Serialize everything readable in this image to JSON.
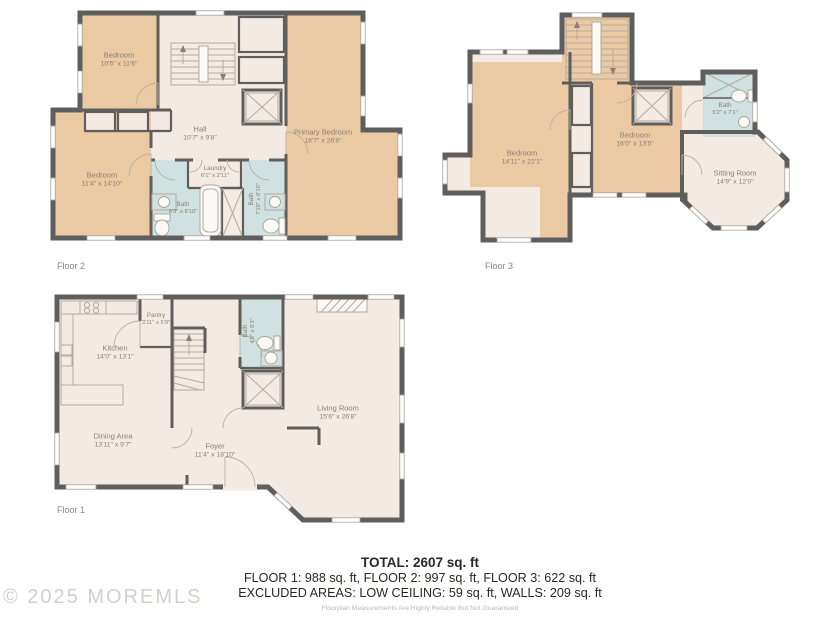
{
  "watermark": "© 2025 MOREMLS",
  "colors": {
    "wall": "#5f5e5c",
    "room_tan": "#ebc9a3",
    "room_cream": "#f3eae3",
    "room_blue": "#cfe2e1",
    "label_text": "#8b8073",
    "footer_text": "#2b2724",
    "watermark_text": "#d3cfcb"
  },
  "floors": {
    "f2": {
      "caption": "Floor 2",
      "rooms": {
        "bedroom1": {
          "name": "Bedroom",
          "dims": "10'5\" x 11'6\""
        },
        "bedroom2": {
          "name": "Bedroom",
          "dims": "11'4\" x 14'10\""
        },
        "hall": {
          "name": "Hall",
          "dims": "10'7\" x 9'8\""
        },
        "laundry": {
          "name": "Laundry",
          "dims": "6'1\" x 2'11\""
        },
        "bath1": {
          "name": "Bath",
          "dims": "8'3\" x 8'10\""
        },
        "bath2": {
          "name": "Bath",
          "dims": "7'10\" x 8'10\""
        },
        "primary": {
          "name": "Primary Bedroom",
          "dims": "18'7\" x 26'8\""
        }
      }
    },
    "f3": {
      "caption": "Floor 3",
      "rooms": {
        "bedroom1": {
          "name": "Bedroom",
          "dims": "14'11\" x 22'1\""
        },
        "bedroom2": {
          "name": "Bedroom",
          "dims": "16'0\" x 13'5\""
        },
        "bath": {
          "name": "Bath",
          "dims": "5'2\" x 7'1\""
        },
        "sitting": {
          "name": "Sitting Room",
          "dims": "14'9\" x 12'0\""
        }
      }
    },
    "f1": {
      "caption": "Floor 1",
      "rooms": {
        "kitchen": {
          "name": "Kitchen",
          "dims": "14'0\" x 13'1\""
        },
        "pantry": {
          "name": "Pantry",
          "dims": "3'11\" x 5'9\""
        },
        "bath": {
          "name": "Bath",
          "dims": "4'9\" x 8'3\""
        },
        "dining": {
          "name": "Dining Area",
          "dims": "13'11\" x 9'7\""
        },
        "foyer": {
          "name": "Foyer",
          "dims": "11'4\" x 18'10\""
        },
        "living": {
          "name": "Living Room",
          "dims": "15'6\" x 26'8\""
        }
      }
    }
  },
  "footer": {
    "total": "TOTAL: 2607 sq. ft",
    "floors_line": "FLOOR 1: 988 sq. ft, FLOOR 2: 997 sq. ft, FLOOR 3: 622 sq. ft",
    "excluded_line": "EXCLUDED AREAS: LOW CEILING: 59 sq. ft, WALLS: 209 sq. ft",
    "disclaimer": "Floorplan Measurements Are Highly Reliable But Not Guaranteed"
  }
}
